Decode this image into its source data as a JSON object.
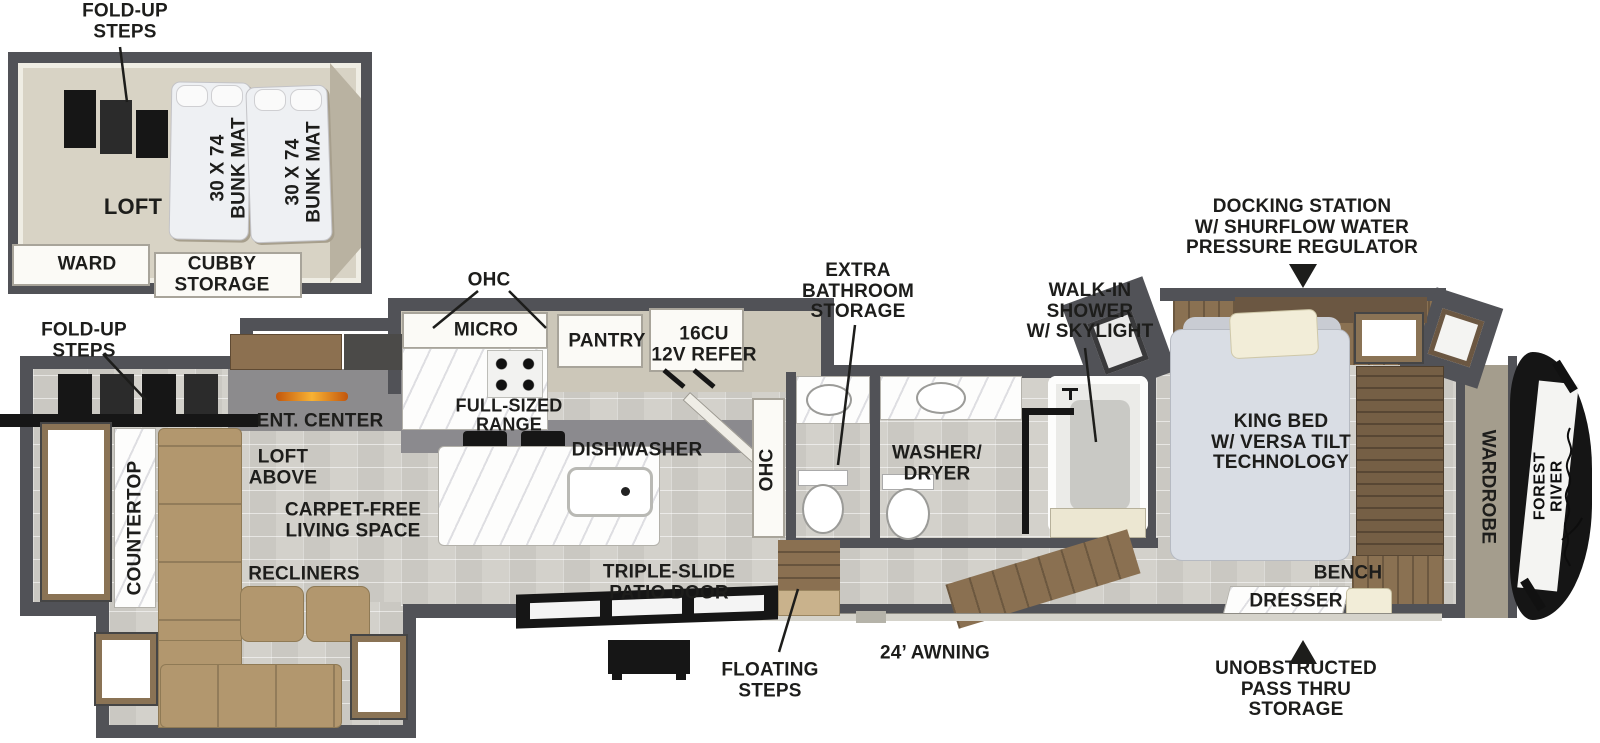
{
  "diagram": {
    "type": "rv-floorplan",
    "brand": "FOREST RIVER",
    "labels": {
      "fold_up_steps_top": "FOLD-UP\nSTEPS",
      "loft": "LOFT",
      "bunk_mat_left": "30 X 74\nBUNK MAT",
      "bunk_mat_right": "30 X 74\nBUNK MAT",
      "ward": "WARD",
      "cubby_storage": "CUBBY\nSTORAGE",
      "ohc_kitchen": "OHC",
      "micro": "MICRO",
      "pantry": "PANTRY",
      "refer": "16CU\n12V REFER",
      "range": "FULL-SIZED\nRANGE",
      "dishwasher": "DISHWASHER",
      "ohc_island": "OHC",
      "extra_bathroom_storage": "EXTRA\nBATHROOM\nSTORAGE",
      "walk_in_shower": "WALK-IN\nSHOWER\nW/ SKYLIGHT",
      "washer_dryer": "WASHER/\nDRYER",
      "docking_station": "DOCKING STATION\nW/ SHURFLOW WATER\nPRESSURE REGULATOR",
      "king_bed": "KING BED\nW/ VERSA TILT\nTECHNOLOGY",
      "wardrobe": "WARDROBE",
      "brand": "FOREST RIVER",
      "bench": "BENCH",
      "dresser": "DRESSER",
      "pass_thru": "UNOBSTRUCTED\nPASS THRU\nSTORAGE",
      "ent_center": "ENT. CENTER",
      "loft_above": "LOFT\nABOVE",
      "countertop": "COUNTERTOP",
      "carpet_free": "CARPET-FREE\nLIVING SPACE",
      "recliners": "RECLINERS",
      "fold_up_steps_left": "FOLD-UP\nSTEPS",
      "patio_door": "TRIPLE-SLIDE\nPATIO DOOR",
      "floating_steps": "FLOATING\nSTEPS",
      "awning": "24’ AWNING"
    },
    "colors": {
      "wall": "#515257",
      "floor_stone": "#d3d1cb",
      "floor_wood": "#8a7152",
      "slide_floor": "#ccc7b9",
      "sofa_tan": "#b2976e",
      "cream": "#f2edd8",
      "bed_gray": "#d9dde4",
      "fireplace_orange": "#f59a1c",
      "cap_black": "#151515",
      "label_ink": "#1d1d1b",
      "wardrobe_band": "#a49d8d"
    }
  }
}
